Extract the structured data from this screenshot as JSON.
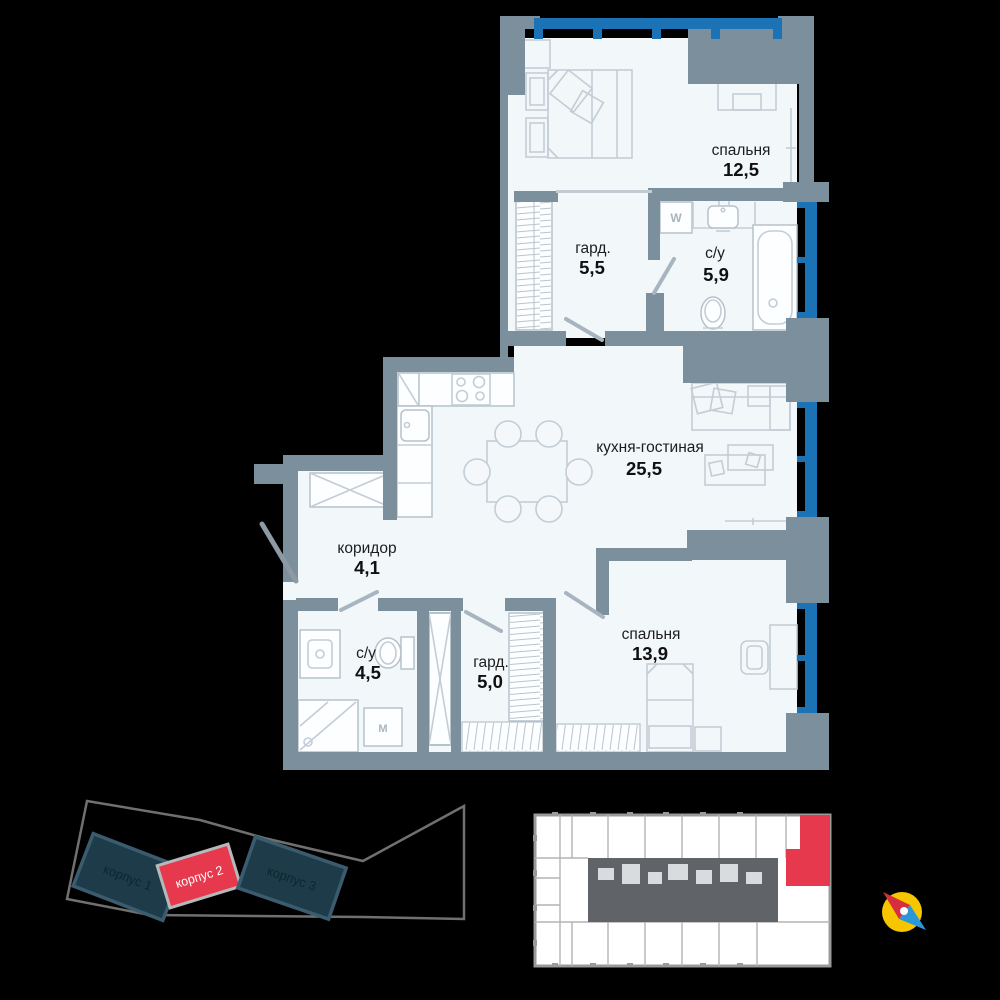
{
  "floor_plan": {
    "rooms": [
      {
        "id": "bedroom-1",
        "name": "спальня",
        "area": "12,5"
      },
      {
        "id": "wardrobe-1",
        "name": "гард.",
        "area": "5,5"
      },
      {
        "id": "bathroom-1",
        "name": "с/у",
        "area": "5,9"
      },
      {
        "id": "kitchen-living",
        "name": "кухня-гостиная",
        "area": "25,5"
      },
      {
        "id": "corridor",
        "name": "коридор",
        "area": "4,1"
      },
      {
        "id": "bathroom-2",
        "name": "с/у",
        "area": "4,5"
      },
      {
        "id": "wardrobe-2",
        "name": "гард.",
        "area": "5,0"
      },
      {
        "id": "bedroom-2",
        "name": "спальня",
        "area": "13,9"
      }
    ],
    "appliances": {
      "washer_large": "W",
      "washer_compact": "M"
    }
  },
  "site_plan": {
    "buildings": [
      {
        "label": "корпус 1",
        "selected": false
      },
      {
        "label": "корпус 2",
        "selected": true
      },
      {
        "label": "корпус 3",
        "selected": false
      }
    ]
  },
  "floor_overview": {
    "selected_unit": "current apartment highlighted"
  },
  "colors": {
    "wall": "#7b8f9d",
    "floor": "#f2f7fa",
    "window_blue": "#1b72b4",
    "accent_red": "#e6394d",
    "building_dark": "#1e3b4a",
    "compass_yellow": "#f7c600",
    "compass_red": "#d62e3e",
    "compass_blue": "#2b97d8"
  }
}
